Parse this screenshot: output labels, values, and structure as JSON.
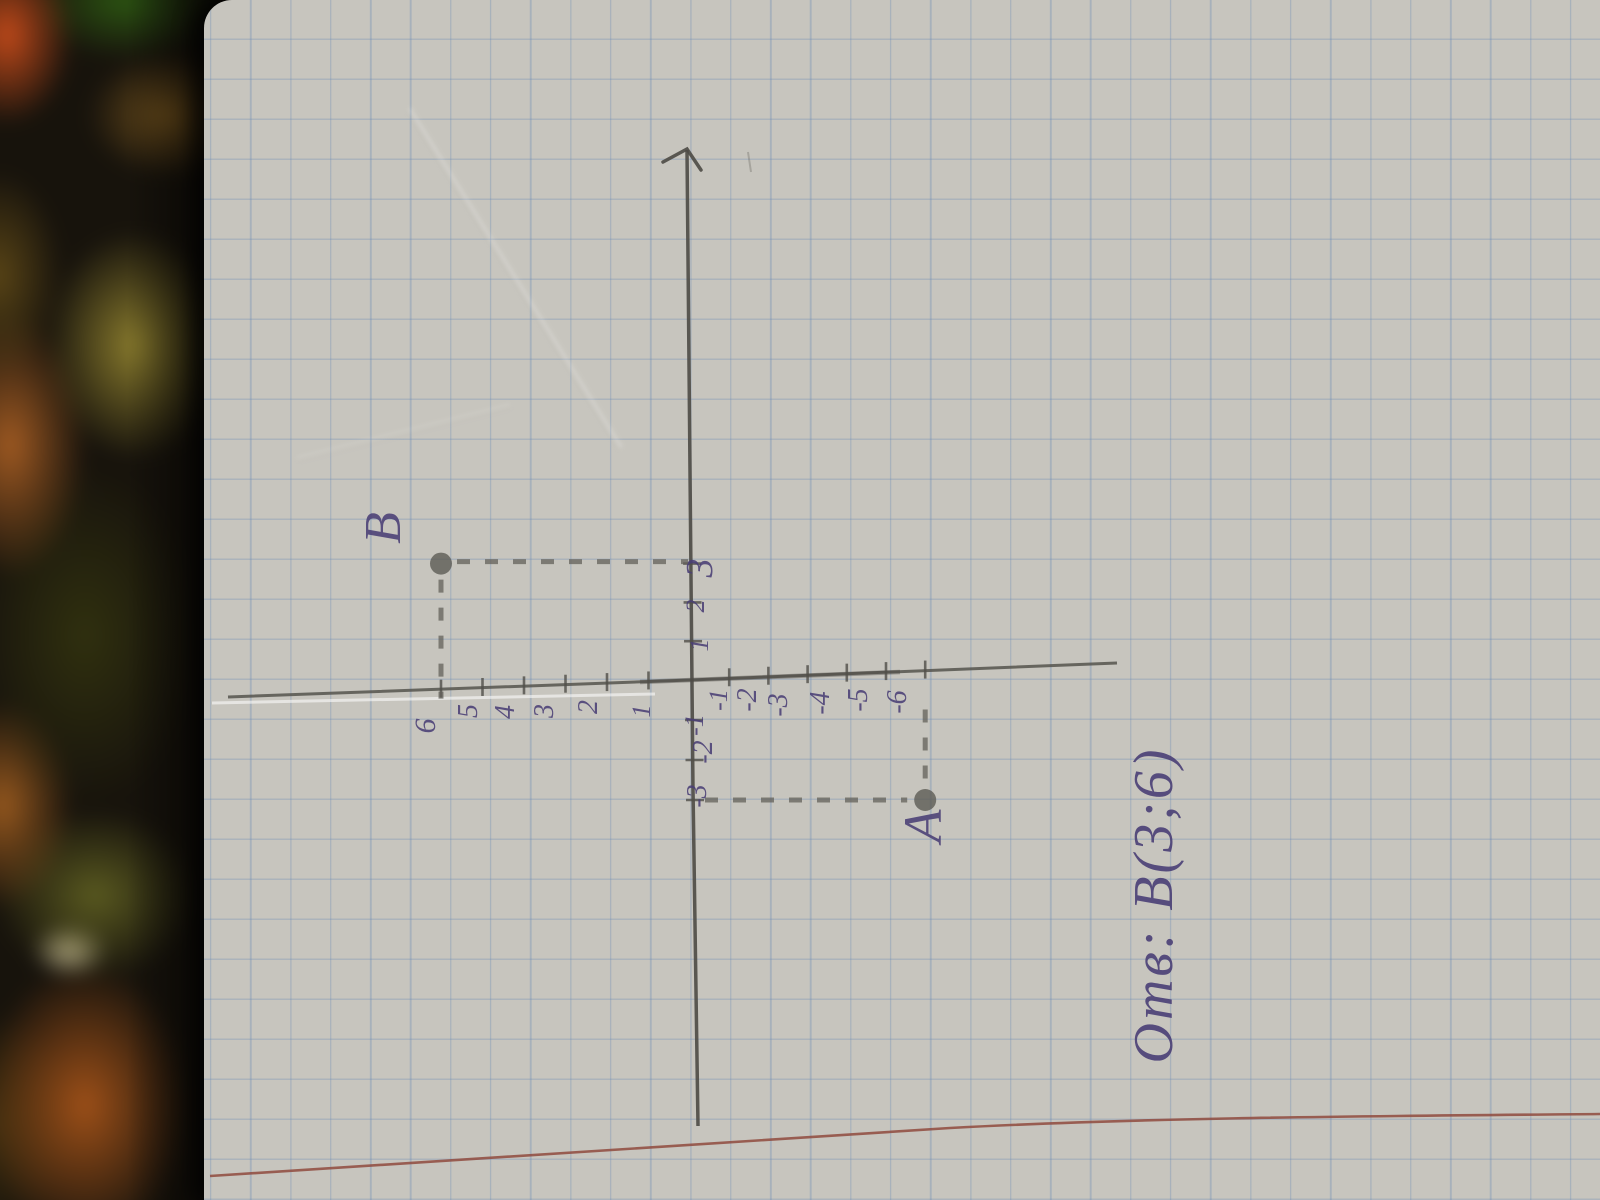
{
  "chart_data": {
    "type": "scatter",
    "title": "",
    "xlabel": "",
    "ylabel": "",
    "grid": "squared-notebook-paper",
    "x_axis": {
      "ticks": [
        1,
        2,
        3,
        -1,
        -2,
        -3
      ],
      "range": [
        -3,
        3
      ]
    },
    "y_axis": {
      "ticks": [
        1,
        2,
        3,
        4,
        5,
        6,
        -1,
        -2,
        -3,
        -4,
        -5,
        -6
      ],
      "range": [
        -6,
        6
      ]
    },
    "points": [
      {
        "label": "А",
        "x": -3,
        "y": -6
      },
      {
        "label": "В",
        "x": 3,
        "y": 6
      }
    ],
    "annotations": [
      "Отв: В(3;6)"
    ]
  },
  "annotation": {
    "answer_text": "Отв: В(3;6)"
  },
  "colors": {
    "ink": "#4a3f76",
    "pencil": "#514f49",
    "margin_line": "#8f4a3e",
    "grid_line": "#6a8ab4",
    "paper": "#c7c5be",
    "carpet_orange": "#b05a1e",
    "carpet_green": "#2c5512",
    "carpet_dark": "#17130c"
  }
}
